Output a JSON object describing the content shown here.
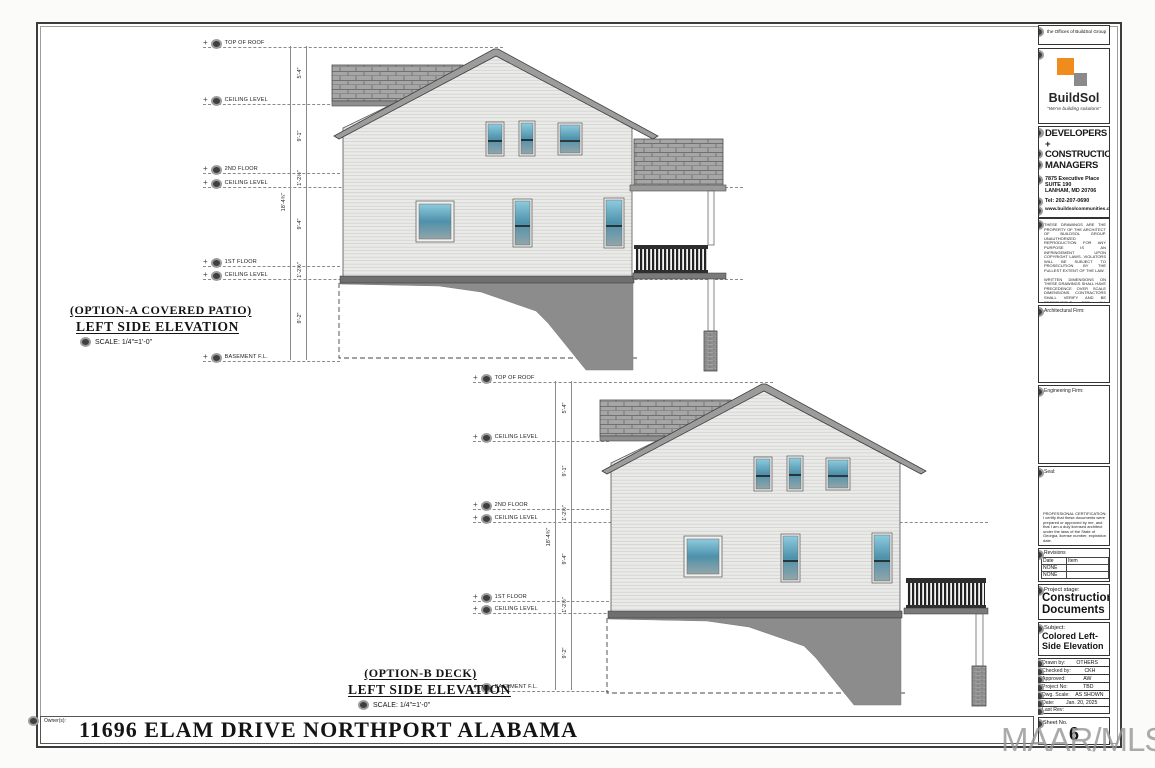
{
  "page": {
    "owner_label": "Owner(s):",
    "project_address": "11696 ELAM DRIVE NORTHPORT ALABAMA",
    "watermark": "MAAR/MLS"
  },
  "title_block": {
    "office_header": "the Offices of BuildSol Group",
    "brand_name": "BuildSol",
    "brand_tagline": "\"We're building solutions\"",
    "firm_l1": "DEVELOPERS +",
    "firm_l2": "CONSTRUCTION",
    "firm_l3": "MANAGERS",
    "address_l1": "7875 Executive Place",
    "address_l2": "SUITE 190",
    "address_l3": "LANHAM, MD 20706",
    "tel": "Tel: 202-207-0690",
    "website": "www.buildsolcommunities.com",
    "disclaimer_p1": "THESE DRAWINGS ARE THE PROPERTY OF THE ARCHITECT OF BUILDSOL GROUP. UNAUTHORIZED REPRODUCTION FOR ANY PURPOSE IS AN INFRINGEMENT UPON COPYRIGHT LAWS. VIOLATORS WILL BE SUBJECT TO PROSECUTION BY THE FULLEST EXTENT OF THE LAW.",
    "disclaimer_p2": "WRITTEN DIMENSIONS ON THESE DRAWINGS SHALL HAVE PRECEDENCE OVER SCALE DIMENSIONS. CONTRACTORS SHALL VERIFY AND BE RESPONSIBLE FOR ALL DIMENSIONS AND CONDITIONS ON THE JOB AND THIS OFFICE MUST BE NOTIFIED OF ANY VARIATION FROM THE DIMENSIONS AND CONDITIONS SHOWN BY THESE DRAWINGS.",
    "architectural_firm_label": "Architectural Firm:",
    "engineering_firm_label": "Engineering Firm:",
    "seal_label": "Seal:",
    "certification": "PROFESSIONAL CERTIFICATION: I certify that these documents were prepared or approved by me, and that I am a duly licensed architect under the laws of the State of Georgia, license number, expiration date.",
    "revisions": {
      "title": "Revisions",
      "col_date": "Date",
      "col_item": "Item",
      "r1_date": "NONE",
      "r1_item": "",
      "r2_date": "NONE",
      "r2_item": ""
    },
    "stage_label": "Project stage:",
    "stage_l1": "Construction",
    "stage_l2": "Documents",
    "subject_label": "Subject:",
    "subject_l1": "Colored Left-",
    "subject_l2": "Side Elevation",
    "meta": [
      {
        "label": "Drawn by:",
        "value": "OTHERS"
      },
      {
        "label": "Checked by:",
        "value": "CKH"
      },
      {
        "label": "Approved:",
        "value": "AW"
      },
      {
        "label": "Project No:",
        "value": "TBD"
      },
      {
        "label": "Dwg. Scale:",
        "value": "AS SHOWN"
      },
      {
        "label": "Date:",
        "value": "Jan. 20, 2025"
      },
      {
        "label": "Last Rev:",
        "value": ""
      }
    ],
    "sheet_no_label": "Sheet No.",
    "sheet_no": "6"
  },
  "elevations": [
    {
      "option": "(OPTION-A COVERED PATIO)",
      "view": "LEFT SIDE ELEVATION",
      "scale": "SCALE:  1/4\"=1'-0\"",
      "levels": [
        "TOP OF ROOF",
        "CEILING LEVEL",
        "2ND FLOOR",
        "CEILING LEVEL",
        "1ST FLOOR",
        "CEILING LEVEL",
        "BASEMENT F.L."
      ]
    },
    {
      "option": "(OPTION-B DECK)",
      "view": "LEFT SIDE ELEVATION",
      "scale": "SCALE:  1/4\"=1'-0\"",
      "levels": [
        "TOP OF ROOF",
        "CEILING LEVEL",
        "2ND FLOOR",
        "CEILING LEVEL",
        "1ST FLOOR",
        "CEILING LEVEL",
        "BASEMENT F.L."
      ]
    }
  ],
  "dimensions": {
    "d1": "5'-4\"",
    "d2": "9'-1\"",
    "d3": "1'-2½\"",
    "d4": "9'-4\"",
    "d5": "1'-2½\"",
    "d6": "9'-2\"",
    "overall": "18'-4¾\""
  },
  "colors": {
    "accent_orange": "#F08C1E",
    "logo_gray": "#8A8A8A",
    "roof_gray": "#9C9C9C",
    "glass_blue": "#4E91AB",
    "foundation_gray": "#8C8C8C"
  }
}
